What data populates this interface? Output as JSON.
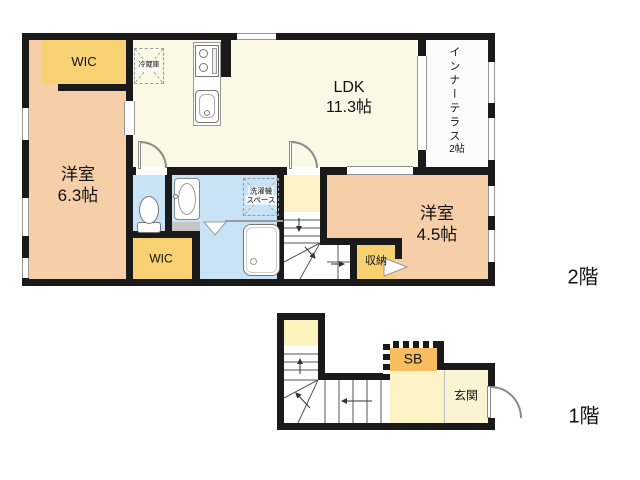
{
  "floors": {
    "second": {
      "label": "2階"
    },
    "first": {
      "label": "1階"
    }
  },
  "rooms_2f": {
    "wic_top": "WIC",
    "western_room_63": {
      "name": "洋室",
      "size": "6.3帖"
    },
    "ldk": {
      "name": "LDK",
      "size": "11.3帖"
    },
    "inner_terrace": {
      "name": "インナーテラス",
      "size": "2帖"
    },
    "refrigerator": "冷蔵庫",
    "washer_space": {
      "line1": "洗濯機",
      "line2": "スペース"
    },
    "wic_bottom": "WIC",
    "storage": "収納",
    "western_room_45": {
      "name": "洋室",
      "size": "4.5帖"
    }
  },
  "rooms_1f": {
    "shoe_box": "SB",
    "entrance": "玄関"
  },
  "colors": {
    "wall": "#1a1a1a",
    "yellow_wic": "#F8D272",
    "orange_sb": "#F7BD5F",
    "peach_room": "#F6CEA8",
    "cream_ldk": "#FAF9E6",
    "cream_hall": "#FBF3C6",
    "light_yellow_1f": "#FBF2BE",
    "cream_genkan": "#FAF4D2",
    "blue_sanitary": "#C8E2F6",
    "terrace_white": "#FBFBFB"
  }
}
